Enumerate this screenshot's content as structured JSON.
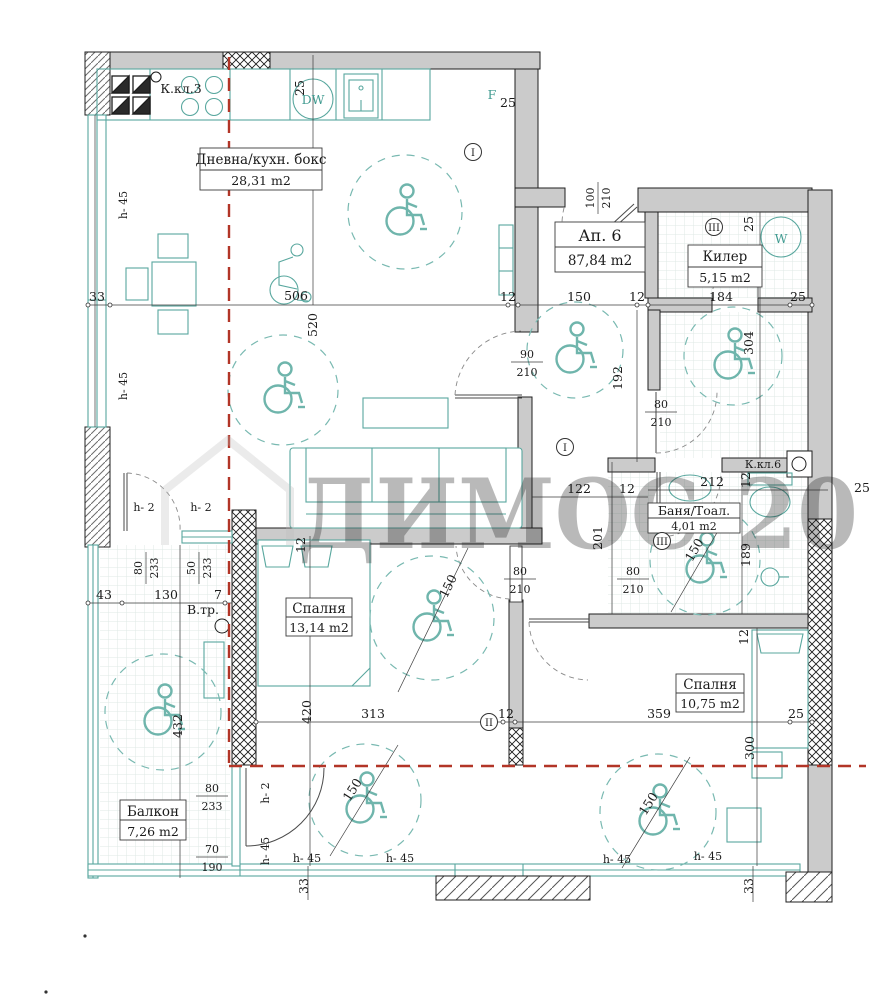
{
  "apartment": {
    "label": "Ап. 6",
    "area": "87,84 m2"
  },
  "rooms": {
    "living": {
      "name": "Дневна/кухн. бокс",
      "area": "28,31 m2"
    },
    "storage": {
      "name": "Килер",
      "area": "5,15 m2"
    },
    "bath": {
      "name": "Баня/Тоал.",
      "area": "4,01 m2"
    },
    "bedroom1": {
      "name": "Спалня",
      "area": "13,14 m2"
    },
    "bedroom2": {
      "name": "Спалня",
      "area": "10,75 m2"
    },
    "balcony": {
      "name": "Балкон",
      "area": "7,26 m2"
    }
  },
  "labels": {
    "kitchen_shaft": "К.кл.3",
    "bath_shaft": "К.кл.6",
    "vent_shaft": "В.тр.",
    "dishwasher": "DW",
    "washer": "W",
    "axis_f": "F",
    "h45": "h- 45",
    "h2": "h- 2",
    "marker1": "I",
    "marker2": "II",
    "marker3": "III"
  },
  "watermark": {
    "text": "ДИМОС-20"
  },
  "dims": {
    "v7": "7",
    "v12": "12",
    "v25": "25",
    "v33": "33",
    "v43": "43",
    "v50": "50",
    "v70": "70",
    "v80": "80",
    "v90": "90",
    "v100": "100",
    "v122": "122",
    "v130": "130",
    "v150": "150",
    "v184": "184",
    "v189": "189",
    "v190": "190",
    "v192": "192",
    "v201": "201",
    "v210": "210",
    "v212": "212",
    "v233": "233",
    "v300": "300",
    "v304": "304",
    "v313": "313",
    "v359": "359",
    "v420": "420",
    "v432": "432",
    "v506": "506",
    "v520": "520"
  },
  "colors": {
    "wall_fill": "#cbcbcb",
    "fixture_teal": "#58a79e",
    "boundary_red": "#b23527",
    "dim_text": "#1b1b1b",
    "watermark_gray": "#c2c2c2"
  }
}
